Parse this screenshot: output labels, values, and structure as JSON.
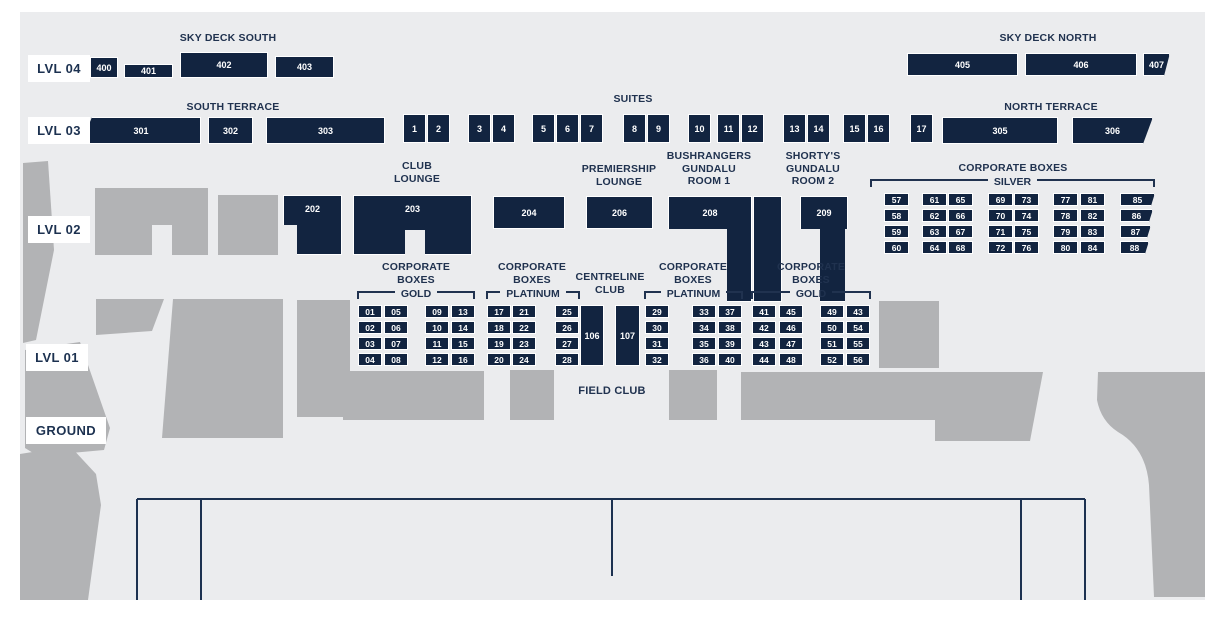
{
  "colors": {
    "canvas": "#ebecee",
    "navy_box": "#122440",
    "heading_text": "#20324f",
    "structure_gray": "#b2b3b5",
    "box_text": "#ffffff",
    "label_bg": "#ffffff"
  },
  "levels": [
    {
      "label": "LVL 04"
    },
    {
      "label": "LVL 03"
    },
    {
      "label": "LVL 02"
    },
    {
      "label": "LVL 01"
    },
    {
      "label": "GROUND"
    }
  ],
  "sky_deck_south": {
    "heading": "SKY DECK SOUTH",
    "boxes": [
      "400",
      "401",
      "402",
      "403"
    ]
  },
  "sky_deck_north": {
    "heading": "SKY DECK NORTH",
    "boxes": [
      "405",
      "406",
      "407"
    ]
  },
  "south_terrace": {
    "heading": "SOUTH TERRACE",
    "boxes": [
      "301",
      "302",
      "303"
    ]
  },
  "north_terrace": {
    "heading": "NORTH TERRACE",
    "boxes": [
      "305",
      "306"
    ]
  },
  "suites": {
    "heading": "SUITES",
    "groups": [
      [
        "1",
        "2"
      ],
      [
        "3",
        "4"
      ],
      [
        "5",
        "6",
        "7"
      ],
      [
        "8",
        "9"
      ],
      [
        "10"
      ],
      [
        "11",
        "12"
      ],
      [
        "13",
        "14"
      ],
      [
        "15",
        "16"
      ],
      [
        "17"
      ]
    ]
  },
  "club_lounge": {
    "heading": "CLUB LOUNGE",
    "boxes": [
      "202",
      "203"
    ]
  },
  "box_204": {
    "label": "204"
  },
  "premiership_lounge": {
    "heading": "PREMIERSHIP LOUNGE",
    "label": "206"
  },
  "bushrangers_room": {
    "heading": "BUSHRANGERS GUNDALU ROOM 1",
    "label": "208"
  },
  "shortys_room": {
    "heading": "SHORTY'S GUNDALU ROOM 2",
    "label": "209"
  },
  "corporate_silver": {
    "heading": "CORPORATE BOXES",
    "tier": "SILVER",
    "columns": [
      [
        "57",
        "58",
        "59",
        "60"
      ],
      [
        "61",
        "62",
        "63",
        "64"
      ],
      [
        "65",
        "66",
        "67",
        "68"
      ],
      [
        "69",
        "70",
        "71",
        "72"
      ],
      [
        "73",
        "74",
        "75",
        "76"
      ],
      [
        "77",
        "78",
        "79",
        "80"
      ],
      [
        "81",
        "82",
        "83",
        "84"
      ],
      [
        "85",
        "86",
        "87",
        "88"
      ]
    ]
  },
  "corporate_gold_left": {
    "heading": "CORPORATE BOXES",
    "tier": "GOLD",
    "columns": [
      [
        "01",
        "02",
        "03",
        "04"
      ],
      [
        "05",
        "06",
        "07",
        "08"
      ],
      [
        "09",
        "10",
        "11",
        "12"
      ],
      [
        "13",
        "14",
        "15",
        "16"
      ]
    ]
  },
  "corporate_platinum_left": {
    "heading": "CORPORATE BOXES",
    "tier": "PLATINUM",
    "columns": [
      [
        "17",
        "18",
        "19",
        "20"
      ],
      [
        "21",
        "22",
        "23",
        "24"
      ],
      [
        "25",
        "26",
        "27",
        "28"
      ]
    ]
  },
  "centreline_club": {
    "heading": "CENTRELINE CLUB",
    "boxes": [
      "106",
      "107"
    ]
  },
  "corporate_platinum_right": {
    "heading": "CORPORATE BOXES",
    "tier": "PLATINUM",
    "columns": [
      [
        "29",
        "30",
        "31",
        "32"
      ],
      [
        "33",
        "34",
        "35",
        "36"
      ],
      [
        "37",
        "38",
        "39",
        "40"
      ]
    ]
  },
  "corporate_gold_right": {
    "heading": "CORPORATE BOXES",
    "tier": "GOLD",
    "columns": [
      [
        "41",
        "42",
        "43",
        "44"
      ],
      [
        "45",
        "46",
        "47",
        "48"
      ],
      [
        "49",
        "50",
        "51",
        "52"
      ],
      [
        "43",
        "54",
        "55",
        "56"
      ]
    ]
  },
  "field_club": {
    "heading": "FIELD CLUB"
  }
}
